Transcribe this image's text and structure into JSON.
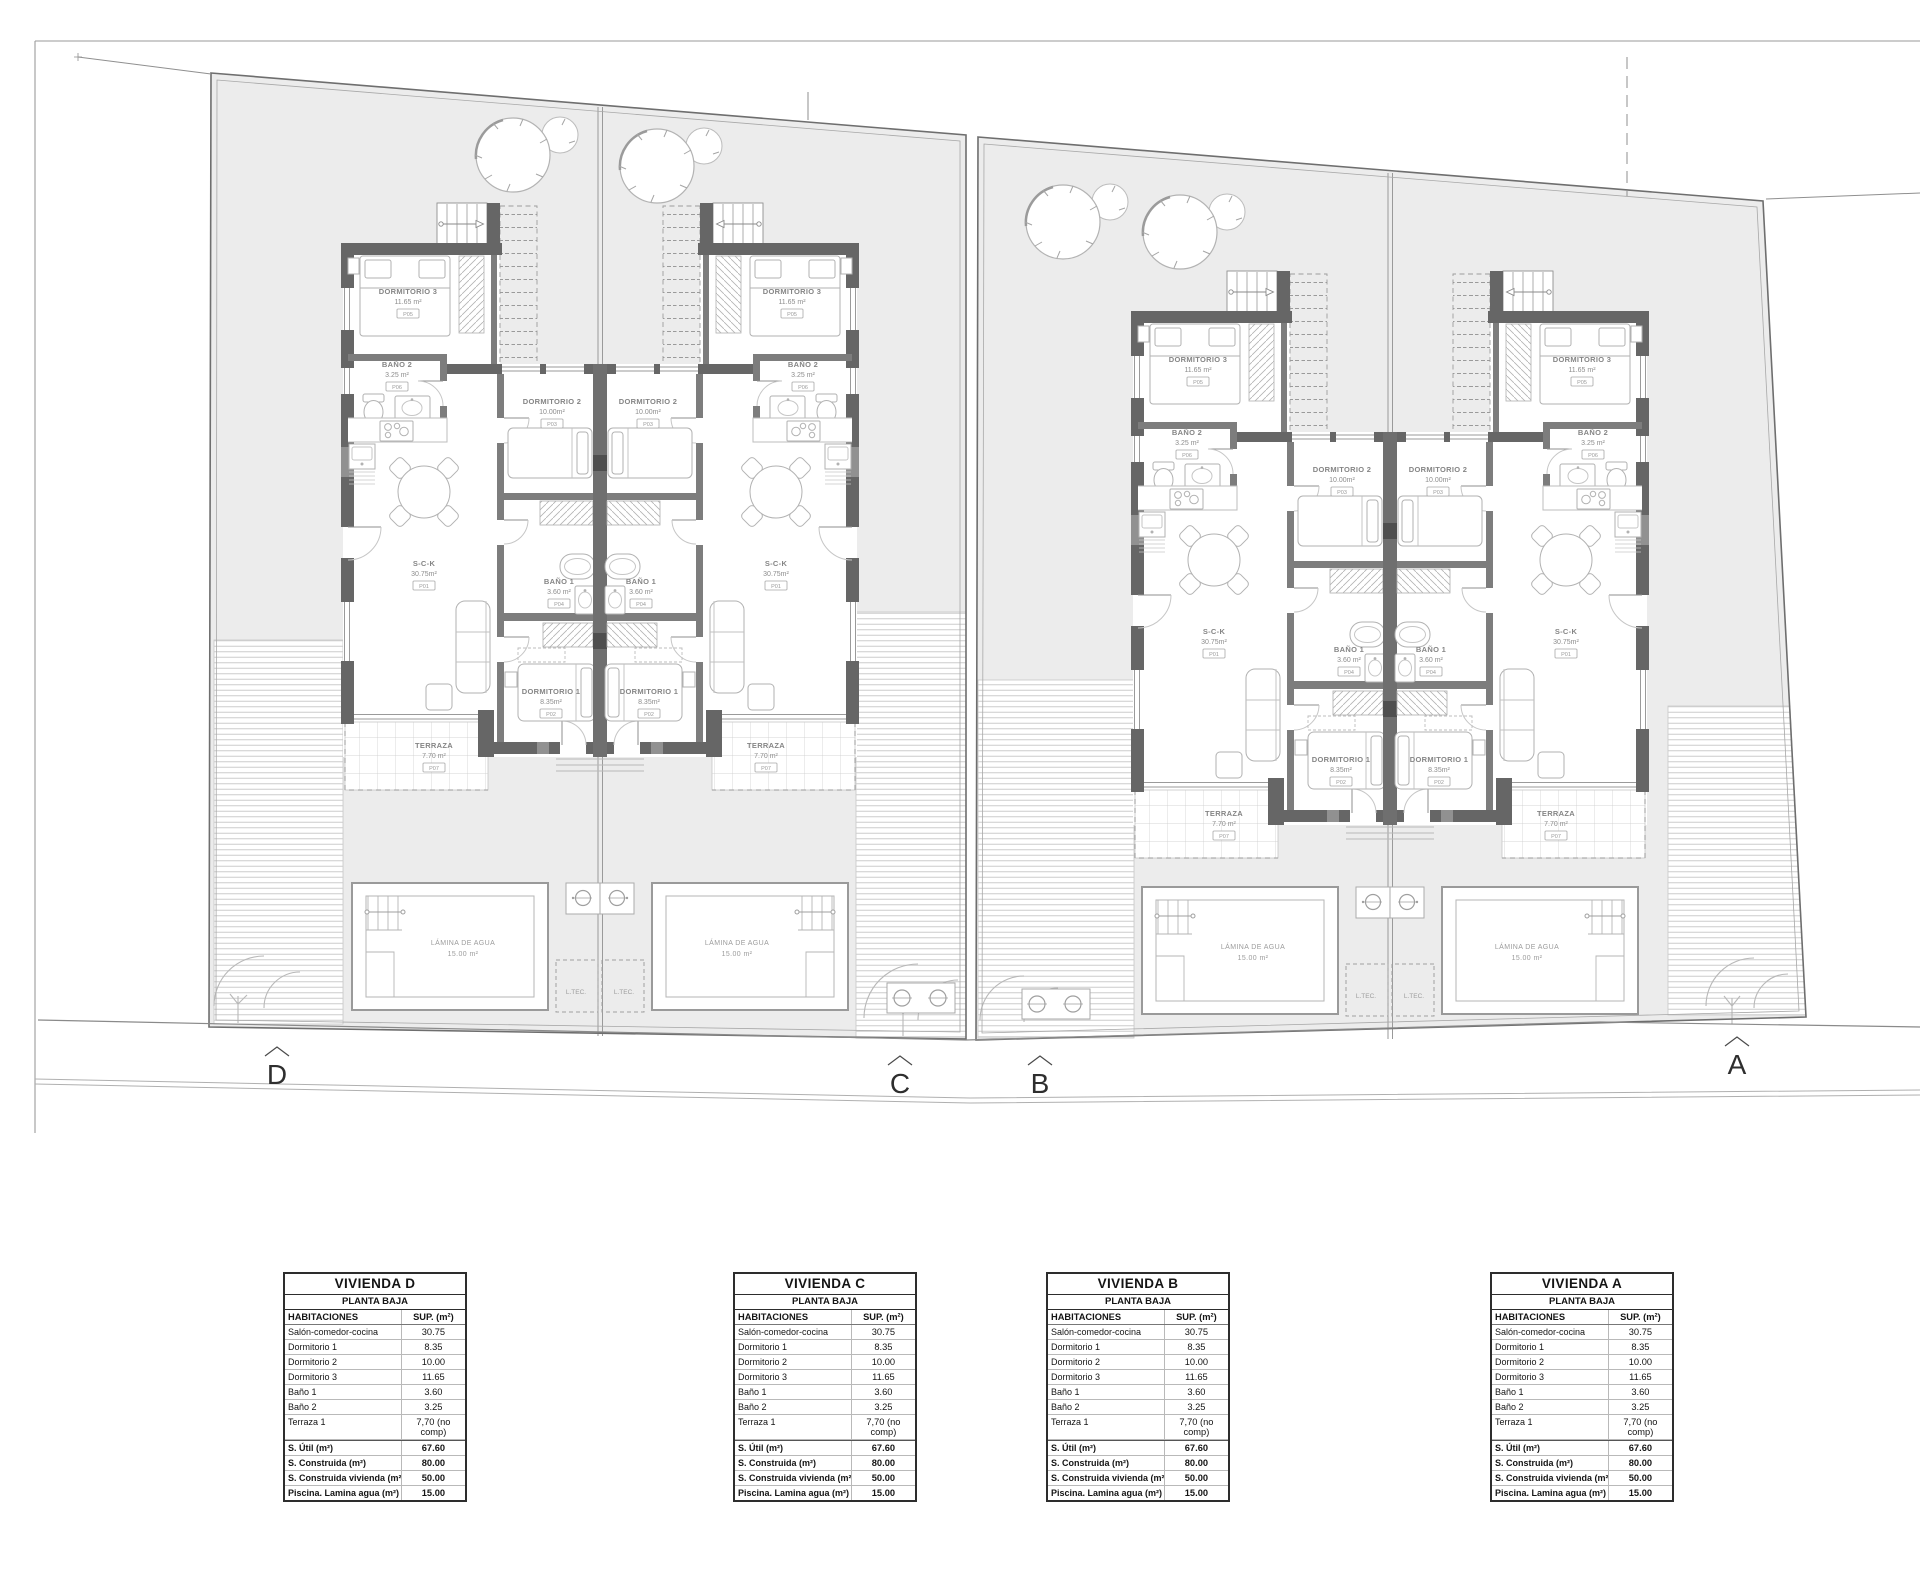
{
  "plan": {
    "section_markers": [
      "D",
      "C",
      "B",
      "A"
    ],
    "unit_ids": [
      "D",
      "C",
      "B",
      "A"
    ],
    "rooms": [
      {
        "name": "DORMITORIO 3",
        "area": "11.65 m²",
        "code": "P05"
      },
      {
        "name": "BAÑO 2",
        "area": "3.25 m²",
        "code": "P06"
      },
      {
        "name": "DORMITORIO 2",
        "area": "10.00m²",
        "code": "P03"
      },
      {
        "name": "S-C-K",
        "area": "30.75m²",
        "code": "P01"
      },
      {
        "name": "BAÑO 1",
        "area": "3.60 m²",
        "code": "P04"
      },
      {
        "name": "DORMITORIO 1",
        "area": "8.35m²",
        "code": "P02"
      },
      {
        "name": "TERRAZA",
        "area": "7.70 m²",
        "code": "P07"
      }
    ],
    "pool_label": {
      "name": "LÁMINA DE AGUA",
      "area": "15.00 m²"
    },
    "tech_room_label": "L.TEC."
  },
  "tables": [
    {
      "title": "VIVIENDA D",
      "subtitle": "PLANTA BAJA",
      "columns": [
        "HABITACIONES",
        "SUP. (m²)"
      ],
      "rows": [
        {
          "label": "Salón-comedor-cocina",
          "value": "30.75"
        },
        {
          "label": "Dormitorio 1",
          "value": "8.35"
        },
        {
          "label": "Dormitorio 2",
          "value": "10.00"
        },
        {
          "label": "Dormitorio 3",
          "value": "11.65"
        },
        {
          "label": "Baño 1",
          "value": "3.60"
        },
        {
          "label": "Baño 2",
          "value": "3.25"
        },
        {
          "label": "Terraza 1",
          "value": "7,70 (no comp)"
        },
        {
          "label": "S. Útil (m²)",
          "value": "67.60",
          "strong": true
        },
        {
          "label": "S. Construida (m²)",
          "value": "80.00",
          "strong": true
        },
        {
          "label": "S. Construida vivienda (m²)",
          "value": "50.00",
          "strong": true
        },
        {
          "label": "Piscina. Lamina agua (m²)",
          "value": "15.00",
          "strong": true
        }
      ]
    },
    {
      "title": "VIVIENDA C",
      "subtitle": "PLANTA BAJA",
      "columns": [
        "HABITACIONES",
        "SUP. (m²)"
      ],
      "rows": [
        {
          "label": "Salón-comedor-cocina",
          "value": "30.75"
        },
        {
          "label": "Dormitorio 1",
          "value": "8.35"
        },
        {
          "label": "Dormitorio 2",
          "value": "10.00"
        },
        {
          "label": "Dormitorio 3",
          "value": "11.65"
        },
        {
          "label": "Baño 1",
          "value": "3.60"
        },
        {
          "label": "Baño 2",
          "value": "3.25"
        },
        {
          "label": "Terraza 1",
          "value": "7,70 (no comp)"
        },
        {
          "label": "S. Útil (m²)",
          "value": "67.60",
          "strong": true
        },
        {
          "label": "S. Construida (m²)",
          "value": "80.00",
          "strong": true
        },
        {
          "label": "S. Construida vivienda (m²)",
          "value": "50.00",
          "strong": true
        },
        {
          "label": "Piscina. Lamina agua (m²)",
          "value": "15.00",
          "strong": true
        }
      ]
    },
    {
      "title": "VIVIENDA B",
      "subtitle": "PLANTA BAJA",
      "columns": [
        "HABITACIONES",
        "SUP. (m²)"
      ],
      "rows": [
        {
          "label": "Salón-comedor-cocina",
          "value": "30.75"
        },
        {
          "label": "Dormitorio 1",
          "value": "8.35"
        },
        {
          "label": "Dormitorio 2",
          "value": "10.00"
        },
        {
          "label": "Dormitorio 3",
          "value": "11.65"
        },
        {
          "label": "Baño 1",
          "value": "3.60"
        },
        {
          "label": "Baño 2",
          "value": "3.25"
        },
        {
          "label": "Terraza 1",
          "value": "7,70 (no comp)"
        },
        {
          "label": "S. Útil (m²)",
          "value": "67.60",
          "strong": true
        },
        {
          "label": "S. Construida (m²)",
          "value": "80.00",
          "strong": true
        },
        {
          "label": "S. Construida vivienda (m²)",
          "value": "50.00",
          "strong": true
        },
        {
          "label": "Piscina. Lamina agua (m²)",
          "value": "15.00",
          "strong": true
        }
      ]
    },
    {
      "title": "VIVIENDA A",
      "subtitle": "PLANTA BAJA",
      "columns": [
        "HABITACIONES",
        "SUP. (m²)"
      ],
      "rows": [
        {
          "label": "Salón-comedor-cocina",
          "value": "30.75"
        },
        {
          "label": "Dormitorio 1",
          "value": "8.35"
        },
        {
          "label": "Dormitorio 2",
          "value": "10.00"
        },
        {
          "label": "Dormitorio 3",
          "value": "11.65"
        },
        {
          "label": "Baño 1",
          "value": "3.60"
        },
        {
          "label": "Baño 2",
          "value": "3.25"
        },
        {
          "label": "Terraza 1",
          "value": "7,70 (no comp)"
        },
        {
          "label": "S. Útil (m²)",
          "value": "67.60",
          "strong": true
        },
        {
          "label": "S. Construida (m²)",
          "value": "80.00",
          "strong": true
        },
        {
          "label": "S. Construida vivienda (m²)",
          "value": "50.00",
          "strong": true
        },
        {
          "label": "Piscina. Lamina agua (m²)",
          "value": "15.00",
          "strong": true
        }
      ]
    }
  ]
}
